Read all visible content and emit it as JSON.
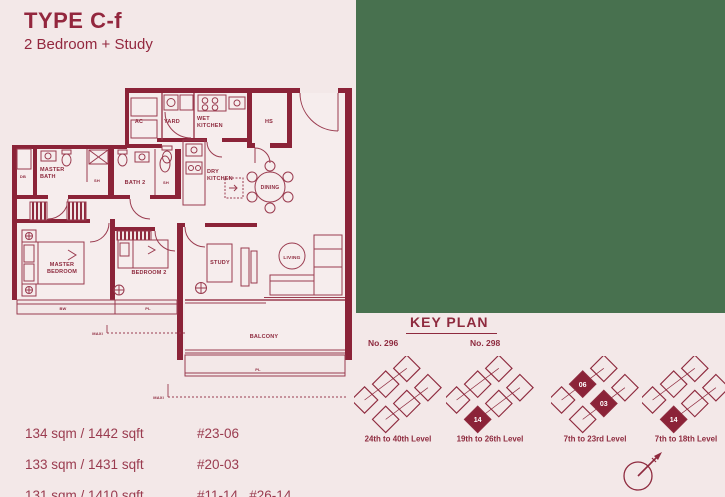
{
  "header": {
    "type_code": "TYPE C-f",
    "subtitle": "2 Bedroom + Study"
  },
  "colors": {
    "background": "#f3e8e8",
    "maroon": "#8e2a3e",
    "maroon_text": "#9a3b4f",
    "green_panel": "#48714f",
    "filled_unit": "#8b2338",
    "unit_number_text": "#ffffff"
  },
  "floor_plan": {
    "labels": [
      {
        "text": "AC",
        "x": 131,
        "y": 41,
        "size": 5.5,
        "anchor": "middle"
      },
      {
        "text": "YARD",
        "x": 164,
        "y": 41,
        "size": 5.5,
        "anchor": "middle"
      },
      {
        "text": "WET",
        "x": 189,
        "y": 38,
        "size": 5.5,
        "anchor": "start"
      },
      {
        "text": "KITCHEN",
        "x": 189,
        "y": 45,
        "size": 5.5,
        "anchor": "start"
      },
      {
        "text": "HS",
        "x": 261,
        "y": 41,
        "size": 5.5,
        "anchor": "middle"
      },
      {
        "text": "DRY",
        "x": 199,
        "y": 91,
        "size": 5.5,
        "anchor": "start"
      },
      {
        "text": "KITCHEN",
        "x": 199,
        "y": 98,
        "size": 5.5,
        "anchor": "start"
      },
      {
        "text": "DINING",
        "x": 262,
        "y": 107,
        "size": 5,
        "anchor": "middle"
      },
      {
        "text": "MASTER",
        "x": 32,
        "y": 89,
        "size": 5.5,
        "anchor": "start"
      },
      {
        "text": "BATH",
        "x": 32,
        "y": 96,
        "size": 5.5,
        "anchor": "start"
      },
      {
        "text": "BATH 2",
        "x": 127,
        "y": 102,
        "size": 5.5,
        "anchor": "middle"
      },
      {
        "text": "SH",
        "x": 89,
        "y": 100,
        "size": 4,
        "anchor": "middle"
      },
      {
        "text": "SH",
        "x": 158,
        "y": 102,
        "size": 4,
        "anchor": "middle"
      },
      {
        "text": "DB",
        "x": 15,
        "y": 96,
        "size": 4,
        "anchor": "middle"
      },
      {
        "text": "MASTER",
        "x": 54,
        "y": 184,
        "size": 5.5,
        "anchor": "middle"
      },
      {
        "text": "BEDROOM",
        "x": 54,
        "y": 191,
        "size": 5.5,
        "anchor": "middle"
      },
      {
        "text": "BEDROOM 2",
        "x": 141,
        "y": 192,
        "size": 5.5,
        "anchor": "middle"
      },
      {
        "text": "STUDY",
        "x": 212,
        "y": 182,
        "size": 5.5,
        "anchor": "middle"
      },
      {
        "text": "LIVING",
        "x": 284,
        "y": 177,
        "size": 4.8,
        "anchor": "middle"
      },
      {
        "text": "BALCONY",
        "x": 256,
        "y": 256,
        "size": 5.5,
        "anchor": "middle"
      },
      {
        "text": "PL",
        "x": 250,
        "y": 289,
        "size": 4,
        "anchor": "middle"
      },
      {
        "text": "PL",
        "x": 140,
        "y": 228,
        "size": 4,
        "anchor": "middle"
      },
      {
        "text": "BW",
        "x": 55,
        "y": 228,
        "size": 4,
        "anchor": "middle"
      },
      {
        "text": "MAXI",
        "x": 95,
        "y": 253,
        "size": 4,
        "anchor": "end"
      },
      {
        "text": "MAXI",
        "x": 156,
        "y": 317,
        "size": 4,
        "anchor": "end"
      }
    ]
  },
  "area_listings": [
    {
      "area": "134 sqm / 1442 sqft",
      "units": "#23-06"
    },
    {
      "area": "133 sqm / 1431 sqft",
      "units": "#20-03"
    },
    {
      "area": "131 sqm / 1410 sqft",
      "units": "#11-14 , #26-14"
    }
  ],
  "key_plan": {
    "title": "KEY PLAN",
    "block_numbers": [
      "No. 296",
      "No. 298"
    ],
    "clusters": [
      {
        "label": "24th to 40th Level",
        "units": [
          null,
          null,
          null,
          null,
          null,
          null
        ]
      },
      {
        "label": "19th to 26th Level",
        "units": [
          null,
          null,
          null,
          null,
          null,
          "14"
        ]
      },
      {
        "label": "7th to 23rd Level",
        "units": [
          null,
          "06",
          null,
          null,
          "03",
          null
        ]
      },
      {
        "label": "7th to 18th Level",
        "units": [
          null,
          null,
          null,
          null,
          null,
          "14"
        ]
      }
    ]
  }
}
